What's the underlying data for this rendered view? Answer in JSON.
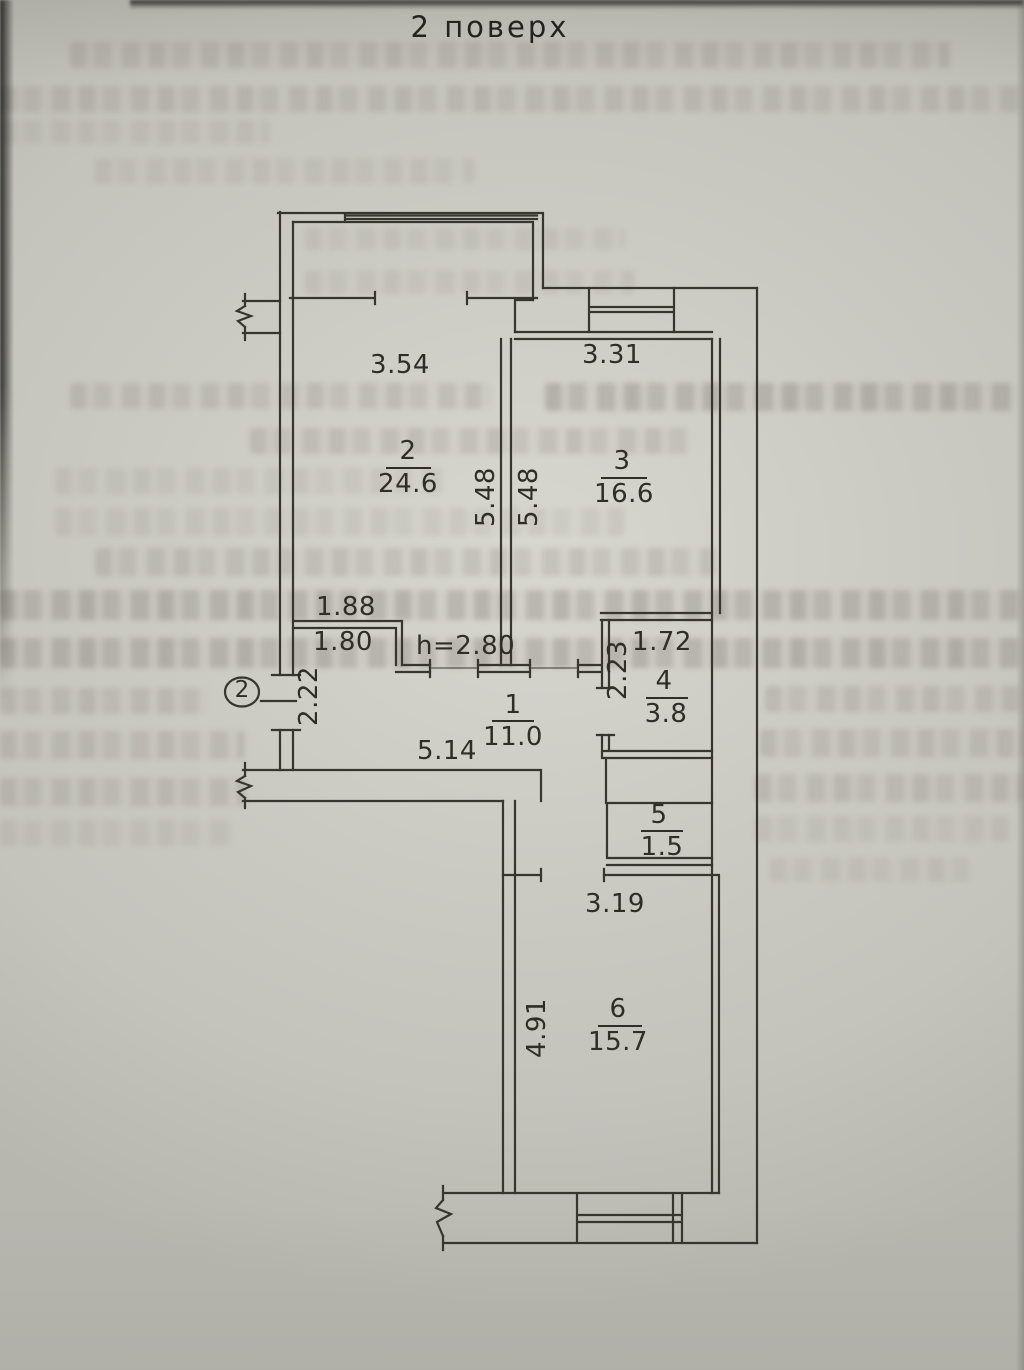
{
  "plan": {
    "title": "2 поверх",
    "marker": "2",
    "rooms": {
      "r1": {
        "num": "1",
        "area": "11.0"
      },
      "r2": {
        "num": "2",
        "area": "24.6"
      },
      "r3": {
        "num": "3",
        "area": "16.6"
      },
      "r4": {
        "num": "4",
        "area": "3.8"
      },
      "r5": {
        "num": "5",
        "area": "1.5"
      },
      "r6": {
        "num": "6",
        "area": "15.7"
      }
    },
    "dims": {
      "a354": "3.54",
      "a331": "3.31",
      "a548L": "5.48",
      "a548R": "5.48",
      "a188": "1.88",
      "a180": "1.80",
      "h280": "h=2.80",
      "a222": "2.22",
      "a514": "5.14",
      "a172": "1.72",
      "a223": "2.23",
      "a319": "3.19",
      "a491": "4.91"
    },
    "colors": {
      "paper": "#c9c8c1",
      "ink": "#36352f"
    }
  }
}
